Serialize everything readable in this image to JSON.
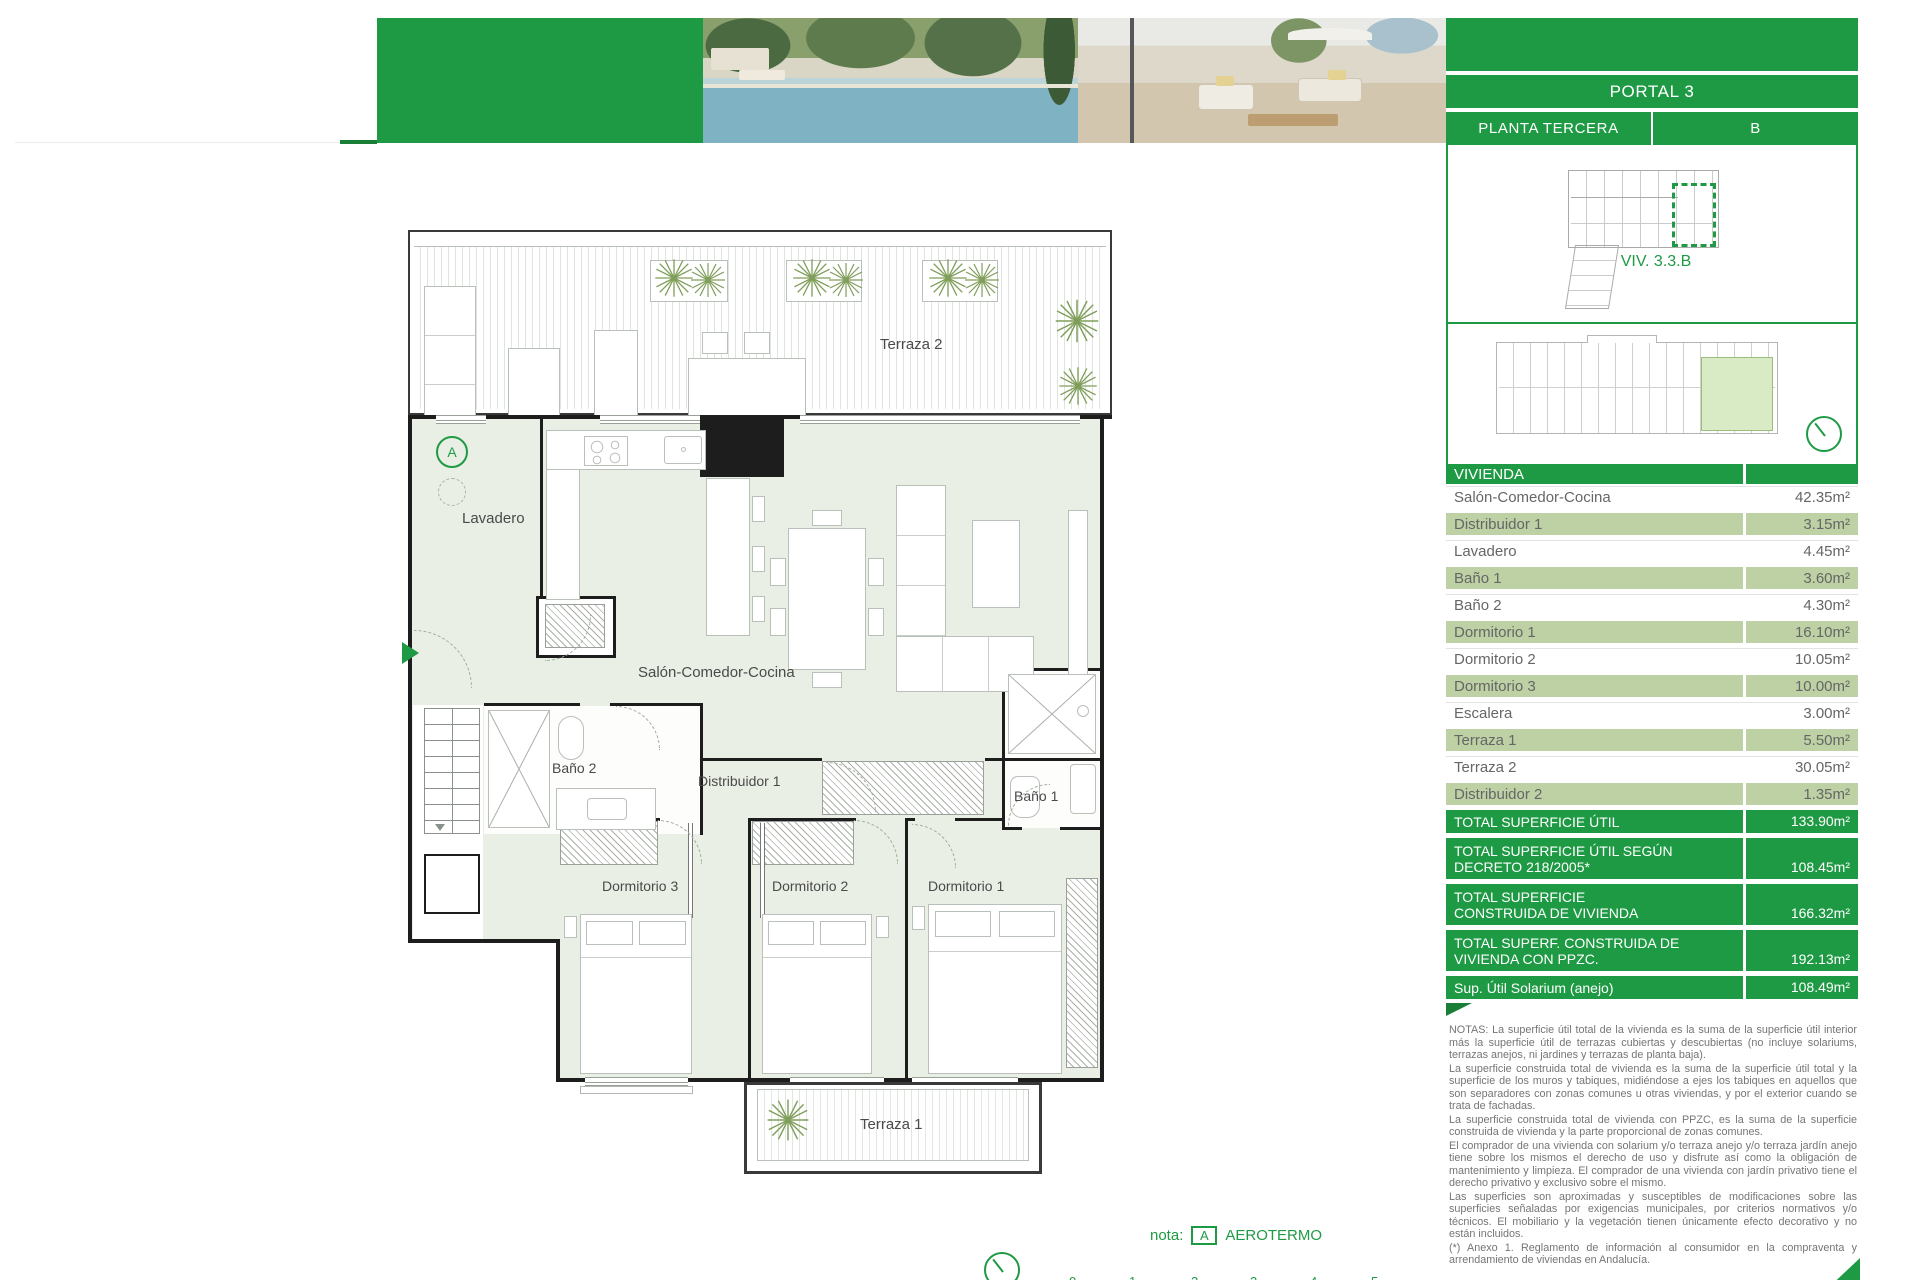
{
  "colors": {
    "brand_green": "#1f9a44",
    "row_green": "#bdd1a4",
    "plan_fill": "#e9efe4",
    "wall": "#1d1d1d"
  },
  "header": {
    "portal": "PORTAL 3",
    "planta": "PLANTA TERCERA",
    "letra": "B",
    "viv": "VIV. 3.3.B"
  },
  "plan": {
    "labels": {
      "terraza2": "Terraza 2",
      "lavadero": "Lavadero",
      "salon": "Salón-Comedor-Cocina",
      "bano2": "Baño 2",
      "distribuidor1": "Distribuidor 1",
      "bano1": "Baño 1",
      "dorm3": "Dormitorio 3",
      "dorm2": "Dormitorio 2",
      "dorm1": "Dormitorio 1",
      "terraza1": "Terraza 1",
      "aerotermo_letter": "A"
    },
    "nota": {
      "prefix": "nota:",
      "letter": "A",
      "text": "AEROTERMO"
    },
    "scale_ticks": [
      "0",
      "1",
      "2",
      "3",
      "4",
      "5"
    ]
  },
  "table": {
    "header": "VIVIENDA",
    "rows": [
      {
        "label": "Salón-Comedor-Cocina",
        "value": "42.35m²"
      },
      {
        "label": "Distribuidor 1",
        "value": "3.15m²"
      },
      {
        "label": "Lavadero",
        "value": "4.45m²"
      },
      {
        "label": "Baño 1",
        "value": "3.60m²"
      },
      {
        "label": "Baño 2",
        "value": "4.30m²"
      },
      {
        "label": "Dormitorio 1",
        "value": "16.10m²"
      },
      {
        "label": "Dormitorio 2",
        "value": "10.05m²"
      },
      {
        "label": "Dormitorio 3",
        "value": "10.00m²"
      },
      {
        "label": "Escalera",
        "value": "3.00m²"
      },
      {
        "label": "Terraza 1",
        "value": "5.50m²"
      },
      {
        "label": "Terraza 2",
        "value": "30.05m²"
      },
      {
        "label": "Distribuidor 2",
        "value": "1.35m²"
      }
    ],
    "totals": [
      {
        "line1": "TOTAL SUPERFICIE ÚTIL",
        "line2": "",
        "value": "133.90m²"
      },
      {
        "line1": "TOTAL SUPERFICIE ÚTIL SEGÚN",
        "line2": "DECRETO 218/2005*",
        "value": "108.45m²"
      },
      {
        "line1": "TOTAL SUPERFICIE",
        "line2": "CONSTRUIDA DE VIVIENDA",
        "value": "166.32m²"
      },
      {
        "line1": "TOTAL SUPERF. CONSTRUIDA DE",
        "line2": "VIVIENDA CON PPZC.",
        "value": "192.13m²"
      },
      {
        "line1": "Sup. Útil Solarium (anejo)",
        "line2": "",
        "value": "108.49m²"
      }
    ]
  },
  "notas": {
    "p1": "NOTAS:      La superficie útil total de la vivienda es la suma de la superficie útil interior más la superficie útil de terrazas cubiertas y descubiertas (no incluye solariums, terrazas anejos, ni jardines y terrazas de planta baja).",
    "p2": "La superficie construida total de vivienda es la suma de la superficie útil total y la superficie de los muros y tabiques, midiéndose a ejes los tabiques en aquellos que son separadores con zonas comunes u otras viviendas, y por el exterior cuando se trata de fachadas.",
    "p3": "La superficie construida total de vivienda con PPZC, es la suma de la superficie construida de vivienda y la parte proporcional de zonas comunes.",
    "p4": "El comprador de una vivienda con solarium y/o terraza anejo y/o terraza jardín anejo tiene sobre los mismos el derecho de uso y disfrute así como la obligación de mantenimiento y limpieza. El comprador de una vivienda con jardín privativo tiene el derecho privativo y exclusivo sobre el mismo.",
    "p5": "Las superficies son aproximadas y susceptibles de modificaciones sobre las superficies señaladas por exigencias municipales, por criterios normativos y/o técnicos. El mobiliario y la vegetación tienen únicamente efecto decorativo y no están incluidos.",
    "p6": "(*) Anexo 1. Reglamento de información al consumidor en la compraventa y arrendamiento de viviendas en Andalucía."
  }
}
